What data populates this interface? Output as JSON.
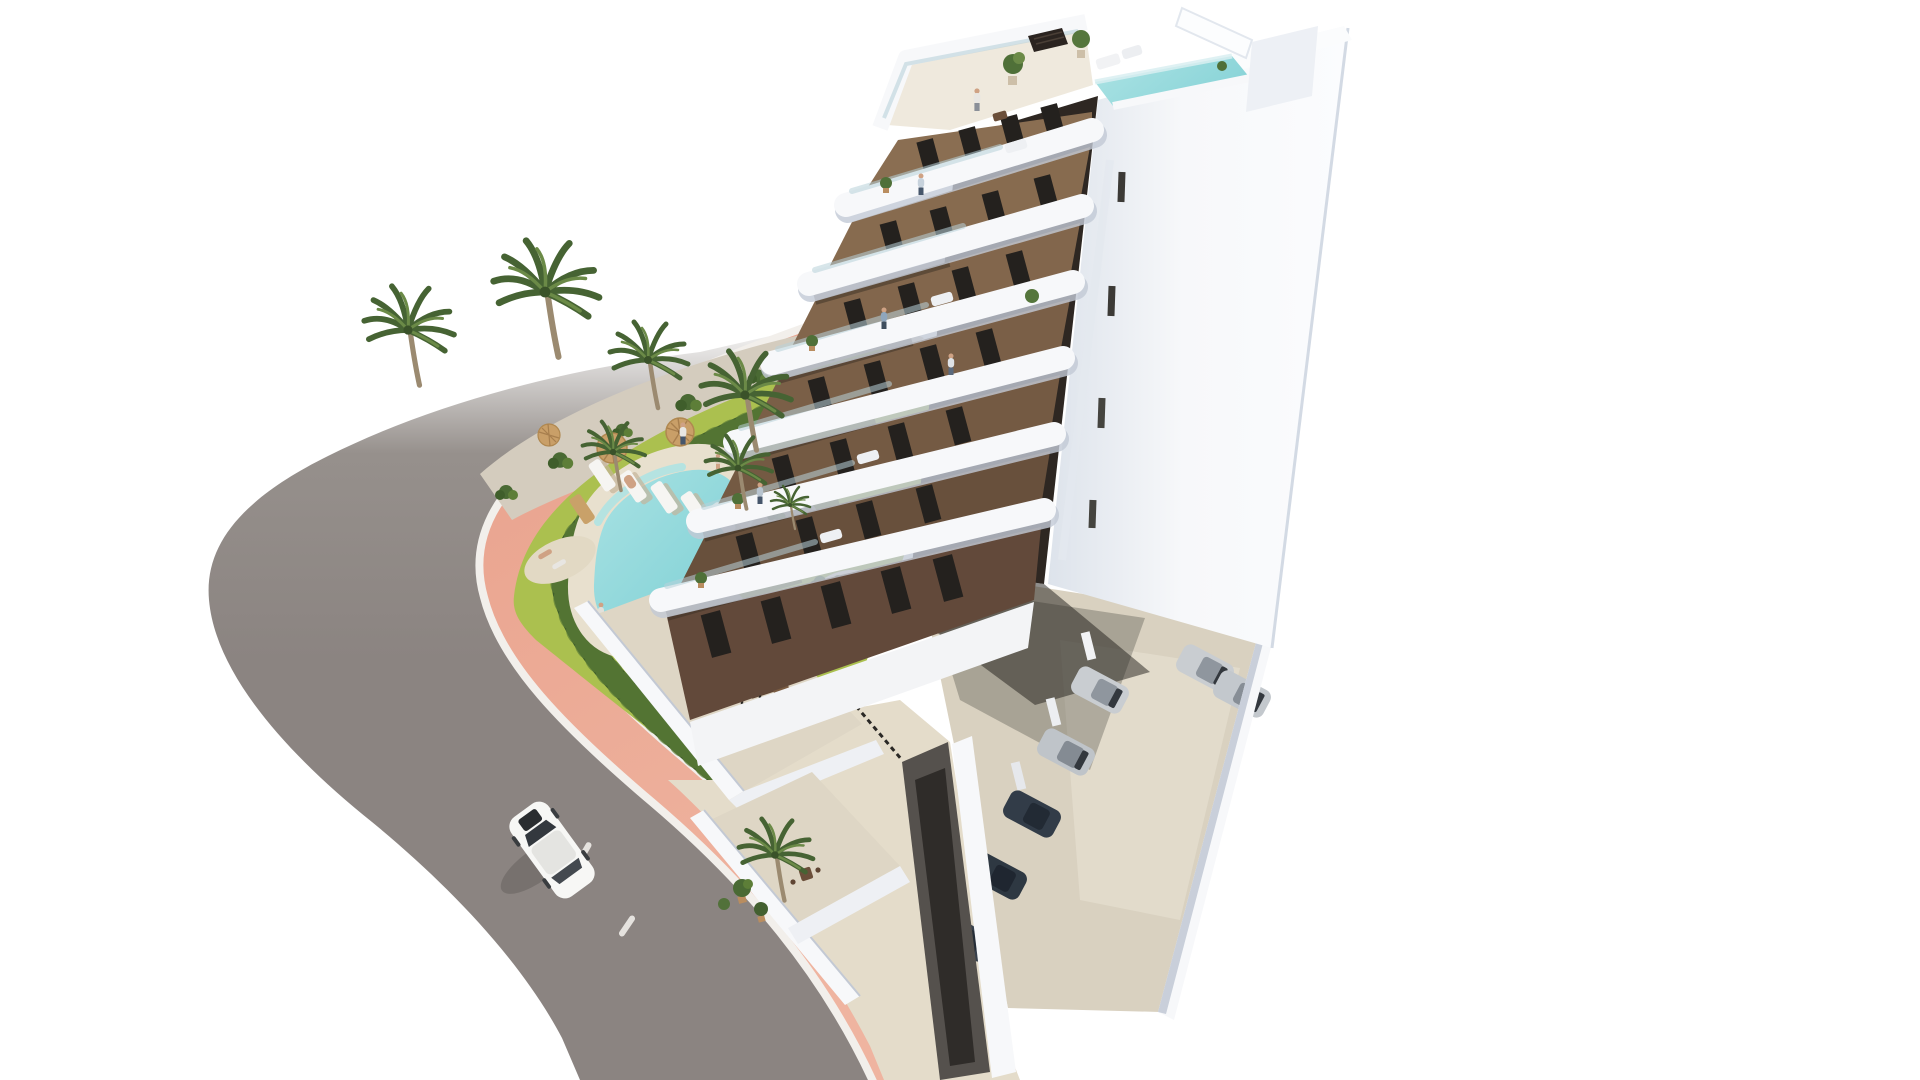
{
  "labels": {
    "scene": "3D architectural rendering of a modern white apartment building with brown balcony facade, rooftop terrace and plunge pool, landscaped garden with freeform swimming pool, palm trees, salmon-pink promenade, curving asphalt road with a white car, and residents parking with cars"
  },
  "palette": {
    "background": "#ffffff",
    "road_asphalt": "#8b8481",
    "road_asphalt_light": "#96908c",
    "road_fade": "#ffffff",
    "road_marking": "#f4f2ee",
    "curb": "#f2efeb",
    "sidewalk_pink": "#e9a28d",
    "sidewalk_pink_light": "#efb4a0",
    "hedge_dark": "#3f5e2b",
    "hedge_light": "#5d7e38",
    "lawn": "#abc04f",
    "lawn_light": "#c0d160",
    "gravel": "#d4ccbe",
    "palm_dark": "#466333",
    "palm_light": "#6b8a47",
    "palm_trunk": "#9b8a70",
    "pool_water": "#79ced3",
    "pool_water_light": "#ace3e4",
    "pool_deck": "#e8e0ce",
    "lounger_white": "#f6f5f2",
    "lounger_wood": "#c9a169",
    "parasol": "#c99f68",
    "building_white": "#f7f8fa",
    "building_white_shade": "#dde3eb",
    "building_white_deep": "#c7ced9",
    "facade_brown": "#8a6e52",
    "facade_brown_mid": "#7a5f47",
    "facade_brown_dark": "#68503c",
    "window_dark": "#24211e",
    "recess_dark": "#2e2722",
    "roof_floor": "#efe9dd",
    "roof_pool": "#8ad4d8",
    "concrete": "#d9d1c0",
    "walkway": "#e4dcca",
    "terrace_floor": "#ded6c5",
    "ramp": "#55514d",
    "ramp_dark": "#2f2c29",
    "car_white": "#f7f7f5",
    "car_silver": "#c9cdd1",
    "car_dark": "#2e3842",
    "car_glass": "#33383e",
    "furniture_wood": "#5f4533",
    "shirt_light": "#e8e6e2",
    "shirt_blue": "#8fa6bd",
    "pants": "#46566b",
    "skin": "#cfa284"
  },
  "scene": {
    "building": {
      "floors": 7,
      "balcony_bands": 6,
      "rooftop_features": [
        "terrace",
        "plunge-pool",
        "potted-trees",
        "pergola-box",
        "white-fin"
      ],
      "left_facade": "brown walls, dark full-height windows, white curved cantilevered balconies with glass railings",
      "right_facade": "plain white wall with narrow dark stair-window slits",
      "south_corner": "dark recessed balconies between white slab bands"
    },
    "garden": {
      "palm_trees": 8,
      "sun_loungers": 6,
      "parasols": 3,
      "pool": "freeform turquoise pool with cream deck and beach corner",
      "hedge": "clipped dark green hedge following the pink promenade",
      "lawn": "yellow-green lawn with gravel planting beds and shrubs"
    },
    "street": {
      "road": "gray asphalt avenue curving around the corner plot",
      "sidewalk": "salmon pink promenade with white curbs",
      "driving_cars": 1,
      "lane_dashes": 2
    },
    "parking": {
      "parked_cars": 7,
      "silver_cars": 4,
      "dark_cars": 3,
      "surface": "beige concrete with low white perimeter wall, partly under the building"
    },
    "people": 10
  }
}
